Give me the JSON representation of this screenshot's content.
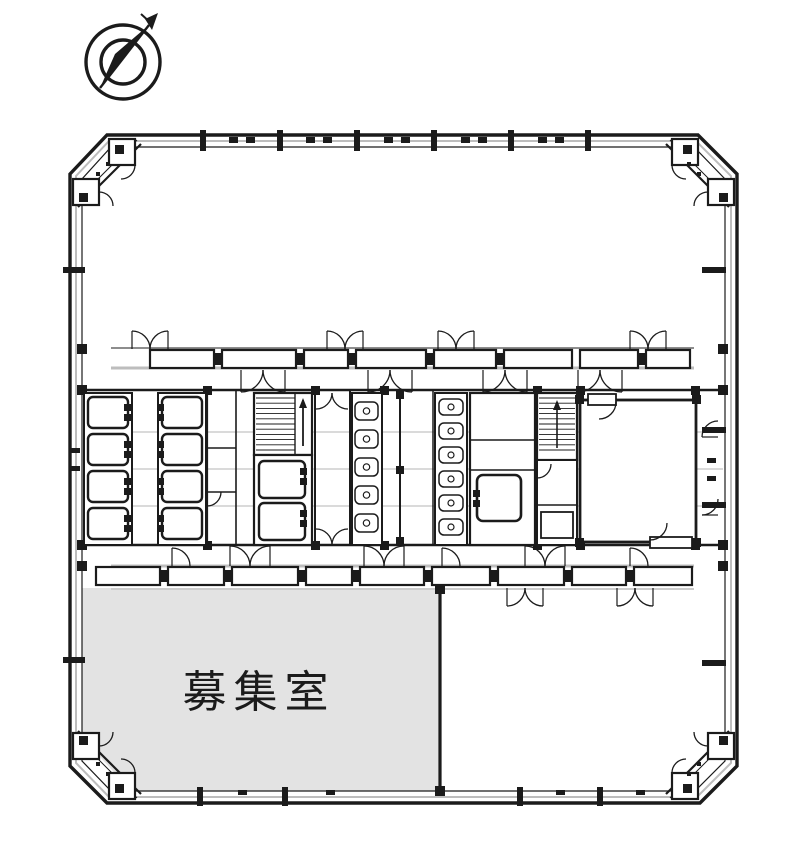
{
  "page": {
    "type": "architectural-floor-plan",
    "description": "office building floor plan with vacant room for lease"
  },
  "compass": {
    "icon": "north-compass-icon"
  },
  "rooms": {
    "vacant_label": "募集室"
  },
  "colors": {
    "line": "#1b1b1b",
    "vacant_fill": "#e3e3e3",
    "glazing": "#bdbdbd",
    "grid": "#c3c3c3",
    "shadow": "#cccccc"
  }
}
